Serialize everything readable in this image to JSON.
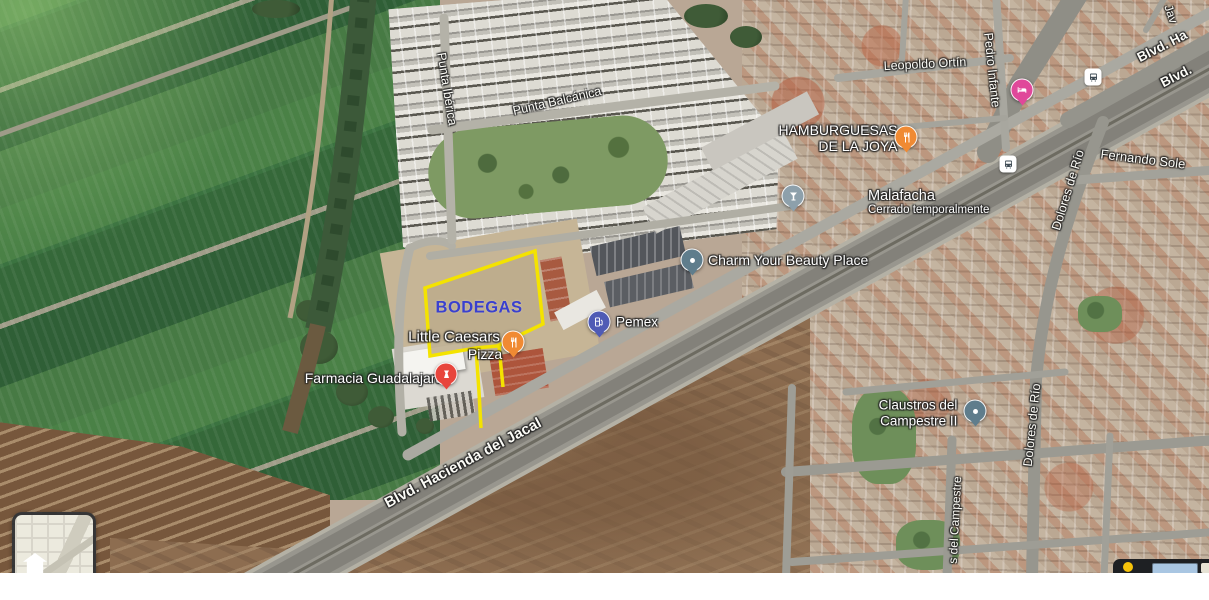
{
  "overlay": {
    "label": "BODEGAS",
    "label_color": "#3A40CF",
    "outline_color": "#F4E300",
    "parcel_points": "425,288 535,251 543,324 497,346 476,348 430,356",
    "corridor_left_points": "476,348 479,392 481,428",
    "corridor_right_points": "499,346 503,387"
  },
  "streets": {
    "punta_iberica": "Punta Ibérica",
    "punta_balcanica": "Punta Balcánica",
    "leopoldo_ortin": "Leopoldo Ortín",
    "pedro_infante": "Pedro Infante",
    "dolores_de_rio": "Dolores de Río",
    "fernando_soler": "Fernando Sole",
    "blvd_ha": "Blvd. Ha",
    "blvd": "Blvd.",
    "jav": "Jav",
    "blvd_hacienda_del_jacal": "Blvd. Hacienda del Jacal",
    "s_del_campestre": "s del Campestre"
  },
  "pois": {
    "hamburguesas": {
      "line1": "HAMBURGUESAS",
      "line2": "DE LA JOYA",
      "icon": "restaurant-icon",
      "color": "#F08A33"
    },
    "malafacha": {
      "name": "Malafacha",
      "status": "Cerrado temporalmente",
      "icon": "bar-icon",
      "color": "#8DA0AB"
    },
    "charm": {
      "name": "Charm Your Beauty Place",
      "icon": "generic-dot-icon",
      "color": "#5F7D8C"
    },
    "pemex": {
      "name": "Pemex",
      "icon": "gas-station-icon",
      "color": "#4F5BB5"
    },
    "little_caesars": {
      "line1": "Little Caesars",
      "line2": "Pizza",
      "icon": "restaurant-icon",
      "color": "#F08A33"
    },
    "farmacia": {
      "name": "Farmacia Guadalajara",
      "icon": "pharmacy-icon",
      "color": "#E8453C"
    },
    "claustros": {
      "line1": "Claustros del",
      "line2": "Campestre II",
      "icon": "generic-dot-icon",
      "color": "#5F7D8C"
    },
    "hotel": {
      "icon": "hotel-icon",
      "color": "#E0489A"
    },
    "bus_stops": {
      "icon": "bus-icon"
    }
  }
}
